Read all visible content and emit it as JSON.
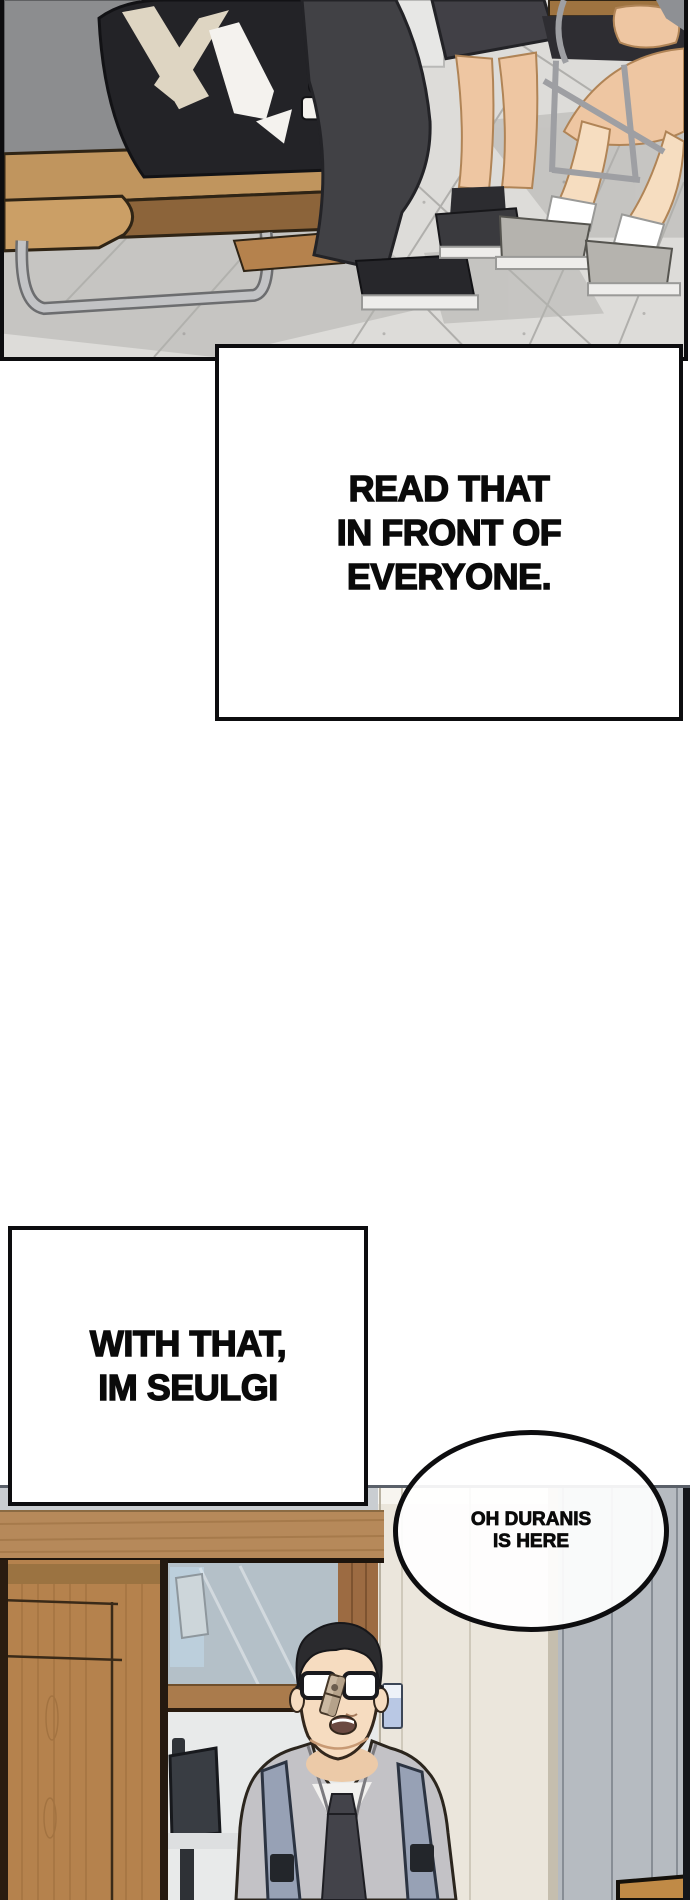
{
  "page": {
    "kind": "webtoon-episode-strip",
    "background": "#ffffff",
    "ink_color": "#0d0d0f",
    "text_color": "#0a0a0a"
  },
  "dialogue_boxes": [
    {
      "id": "box-read-that",
      "lines": [
        "READ THAT",
        "IN FRONT OF",
        "EVERYONE."
      ]
    },
    {
      "id": "box-with-that",
      "lines": [
        "WITH THAT,",
        "IM SEULGI"
      ]
    }
  ],
  "speech_bubble": {
    "lines": [
      "OH DURANIS",
      "IS HERE"
    ]
  },
  "panels": [
    {
      "id": "classroom-floor-panel",
      "colors": {
        "floor": "#dddcd9",
        "grout": "#a6a5a2",
        "jacket": "#232327",
        "arrow_cream": "#ded5c2",
        "arrow_white": "#f4f2ee",
        "desk_wood": "#bf9259",
        "pants": "#414145",
        "skin": "#eec6a2",
        "sock": "#ffffff",
        "sneaker": "#b5b3ae",
        "skirt": "#414046",
        "metal": "#c2c3c5"
      }
    },
    {
      "id": "doorway-panel",
      "colors": {
        "wall": "#b6bbc1",
        "door_cream": "#ebe6dc",
        "cabinet_wood": "#b5824d",
        "header_wood": "#b6895a",
        "glass": "#b4c0c8",
        "classroom": "#e8eaea",
        "monitor": "#393d43",
        "suit": "#c3c2c6",
        "tie": "#43434a",
        "strap": "#97a1b5",
        "buckle": "#23262b",
        "hair": "#2b2b2e",
        "face_skin": "#f6dcc0",
        "door_sign": "#b9c8e4",
        "desk_tan": "#c08a46"
      }
    }
  ]
}
